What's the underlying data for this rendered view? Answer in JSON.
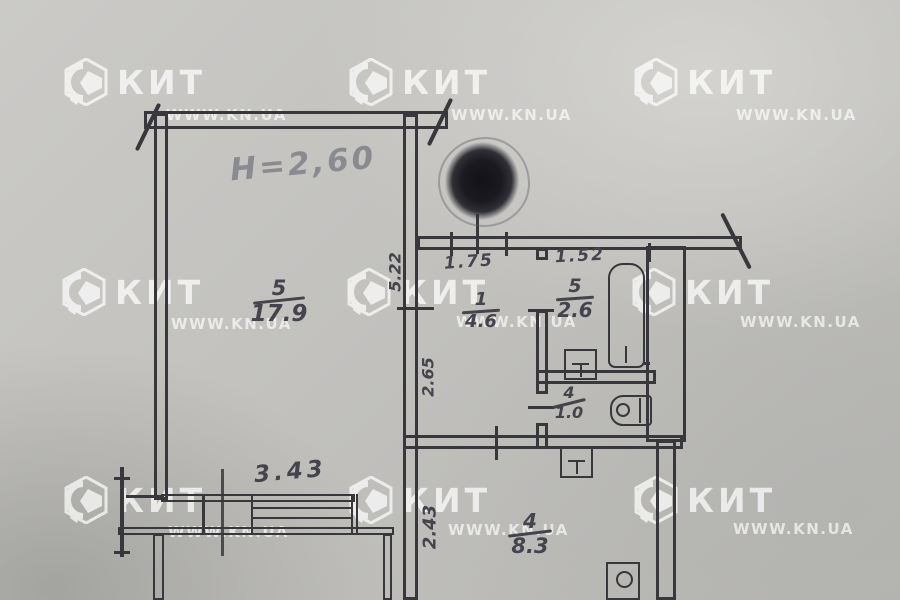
{
  "watermark": {
    "brand": "КИТ",
    "site": "WWW.KN.UA"
  },
  "plan": {
    "ceiling_height_note": "H=2,60",
    "rooms": [
      {
        "number": "5",
        "area": "17.9"
      },
      {
        "number": "1",
        "area": "4.6"
      },
      {
        "number": "5",
        "area": "2.6"
      },
      {
        "number": "4",
        "area": "1.0"
      },
      {
        "number": "4",
        "area": "8.3"
      }
    ],
    "dimensions": {
      "entry_opening_width": "1.75",
      "bathroom_width": "1.52",
      "living_room_depth": "5.22",
      "hallway_depth": "2.65",
      "kitchen_depth": "2.43",
      "window_width": "3.43"
    }
  },
  "colors": {
    "paper": "#c2c1be",
    "ink": "#38373c",
    "pencil": "#45444c",
    "faint_pencil": "#8a8a91",
    "watermark": "#ffffff"
  }
}
